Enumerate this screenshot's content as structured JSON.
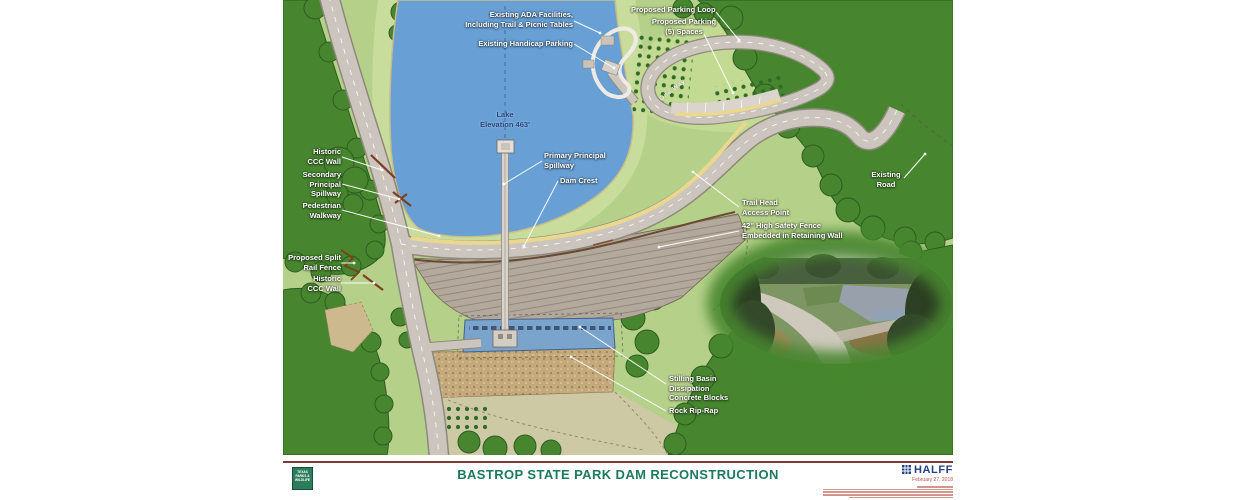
{
  "map": {
    "labels": [
      {
        "id": "existing-ada-facilities",
        "lines": [
          "Existing ADA Facilities,",
          "Including Trail & Picnic Tables"
        ]
      },
      {
        "id": "existing-handicap-parking",
        "lines": [
          "Existing Handicap Parking"
        ]
      },
      {
        "id": "proposed-parking-loop",
        "lines": [
          "Proposed Parking Loop"
        ]
      },
      {
        "id": "proposed-parking-5-spaces",
        "lines": [
          "Proposed Parking",
          "(5) Spaces"
        ]
      },
      {
        "id": "lake-elevation",
        "lines": [
          "Lake",
          "Elevation 463'"
        ]
      },
      {
        "id": "historic-ccc-wall-upper",
        "lines": [
          "Historic",
          "CCC Wall"
        ]
      },
      {
        "id": "secondary-principal-spillway",
        "lines": [
          "Secondary",
          "Principal",
          "Spillway"
        ]
      },
      {
        "id": "pedestrian-walkway",
        "lines": [
          "Pedestrian",
          "Walkway"
        ]
      },
      {
        "id": "primary-principal-spillway",
        "lines": [
          "Primary Principal",
          "Spillway"
        ]
      },
      {
        "id": "dam-crest",
        "lines": [
          "Dam Crest"
        ]
      },
      {
        "id": "proposed-split-rail-fence",
        "lines": [
          "Proposed Split",
          "Rail Fence"
        ]
      },
      {
        "id": "historic-ccc-wall-lower",
        "lines": [
          "Historic",
          "CCC Wall"
        ]
      },
      {
        "id": "trail-head-access-point",
        "lines": [
          "Trail Head",
          "Access Point"
        ]
      },
      {
        "id": "high-safety-fence",
        "lines": [
          "42\" High Safety Fence",
          "Embedded in Retaining Wall"
        ]
      },
      {
        "id": "existing-road",
        "lines": [
          "Existing",
          "Road"
        ]
      },
      {
        "id": "stilling-basin",
        "lines": [
          "Stilling Basin",
          "Dissipation",
          "Concrete Blocks"
        ]
      },
      {
        "id": "rock-rip-rap",
        "lines": [
          "Rock Rip-Rap"
        ]
      },
      {
        "id": "one-way",
        "lines": [
          "One Way"
        ]
      }
    ]
  },
  "footer": {
    "title": "BASTROP STATE PARK DAM RECONSTRUCTION",
    "agency_logo": {
      "lines": [
        "TEXAS",
        "PARKS &",
        "WILDLIFE"
      ]
    },
    "firm": {
      "name": "HALFF",
      "date": "February 27, 2018"
    }
  },
  "colors": {
    "lake_blue": "#68a0d6",
    "grass_green": "#b5d189",
    "forest_green": "#47862f",
    "road_gray": "#ccc5be",
    "walkway_yellow": "#e9d88e",
    "embankment_tan": "#b3a89c",
    "stilling_basin_blue": "#7aa4cc",
    "riprap_tan": "#c3a97b",
    "rule_maroon": "#7b3a33",
    "title_green": "#1b7a5f",
    "halff_blue": "#24418c",
    "date_red": "#c0504d",
    "tpwd_green": "#2c7d5c",
    "ccc_wall_brown": "#7d3f22"
  }
}
